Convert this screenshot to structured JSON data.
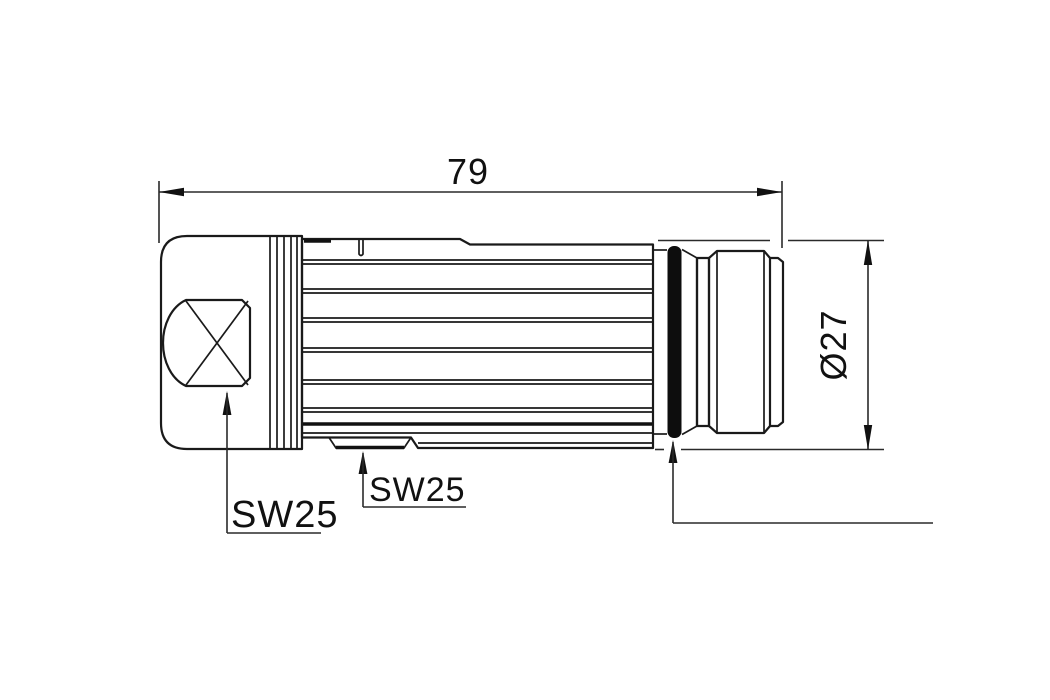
{
  "drawing": {
    "background_color": "#ffffff",
    "line_color": "#1a1a1a",
    "seal_color": "#0d0d0d",
    "labels": {
      "length": "79",
      "diameter": "Ø27",
      "wrench_cap": "SW25",
      "wrench_body": "SW25"
    }
  }
}
